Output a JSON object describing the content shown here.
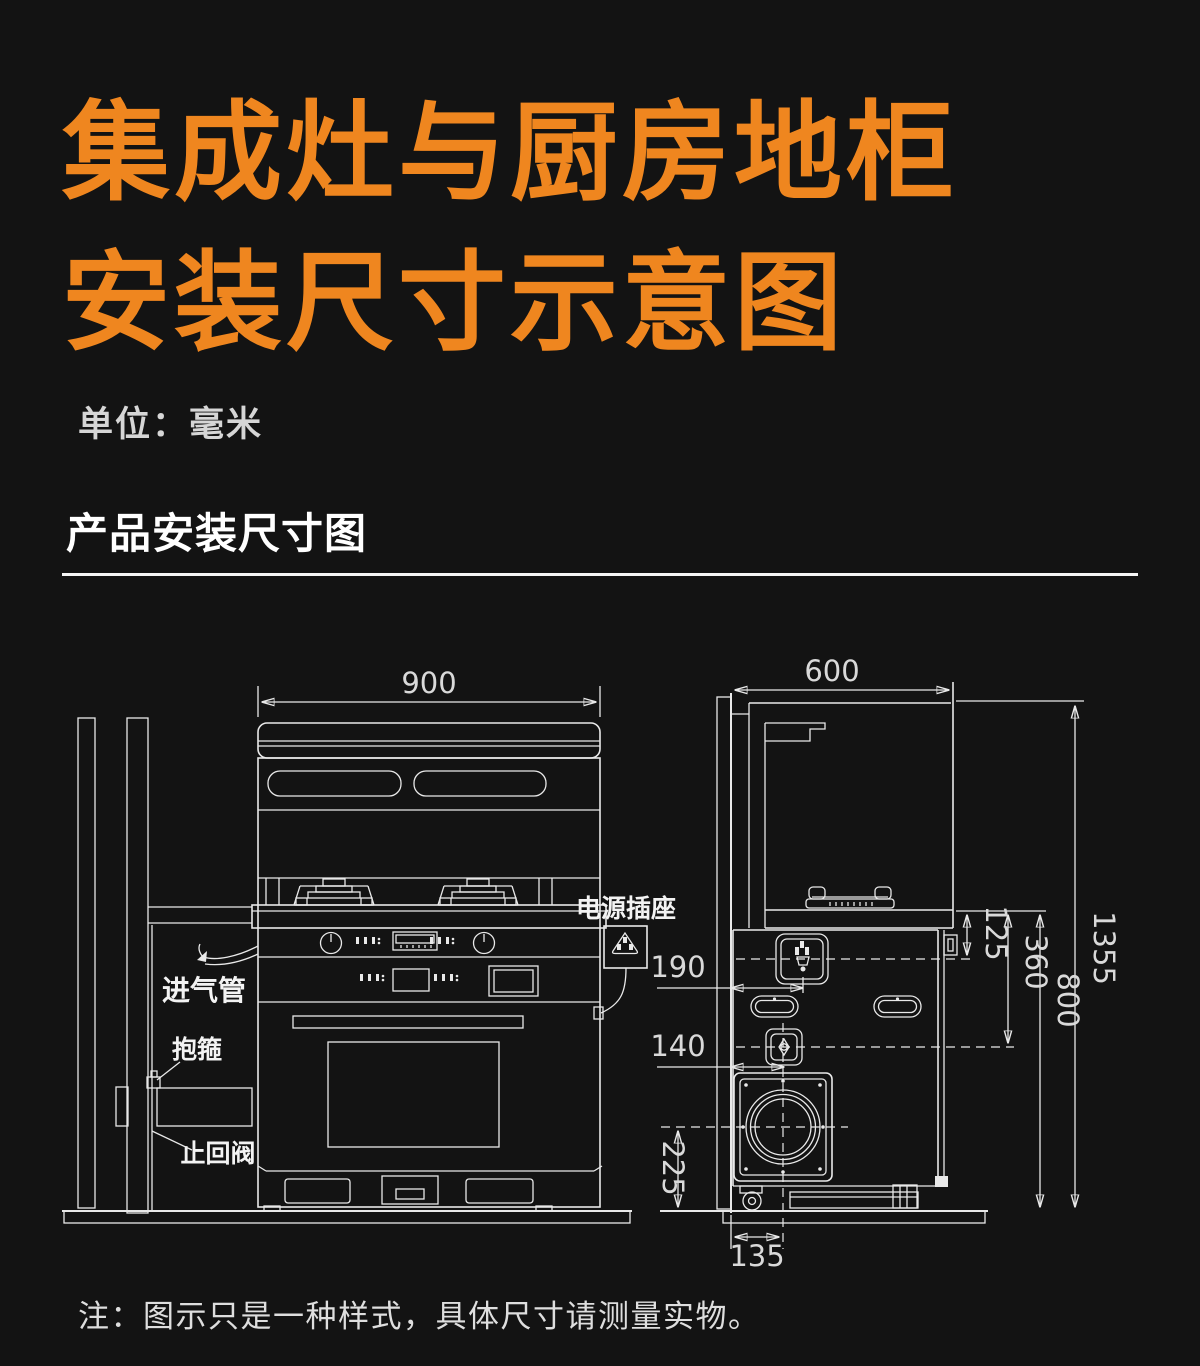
{
  "header": {
    "title_line1": "集成灶与厨房地柜",
    "title_line2": "安装尺寸示意图",
    "unit_label": "单位：毫米",
    "section_title": "产品安装尺寸图"
  },
  "footer": {
    "note": "注：图示只是一种样式，具体尺寸请测量实物。"
  },
  "colors": {
    "background": "#131313",
    "accent_orange": "#EF861F",
    "drawing_line": "#E9E9E9",
    "text_white": "#FFFFFF"
  },
  "diagram": {
    "front": {
      "width": "900",
      "power_socket_label": "电源插座",
      "intake_pipe_label": "进气管",
      "clamp_label": "抱箍",
      "check_valve_label": "止回阀"
    },
    "side": {
      "depth": "600",
      "total_height": "1355",
      "counter_height": "800",
      "socket_below_counter": "125",
      "inlet_below_counter": "360",
      "socket_from_wall": "190",
      "inlet_from_wall": "140",
      "outlet_above_floor": "225",
      "outlet_from_wall": "135"
    }
  }
}
